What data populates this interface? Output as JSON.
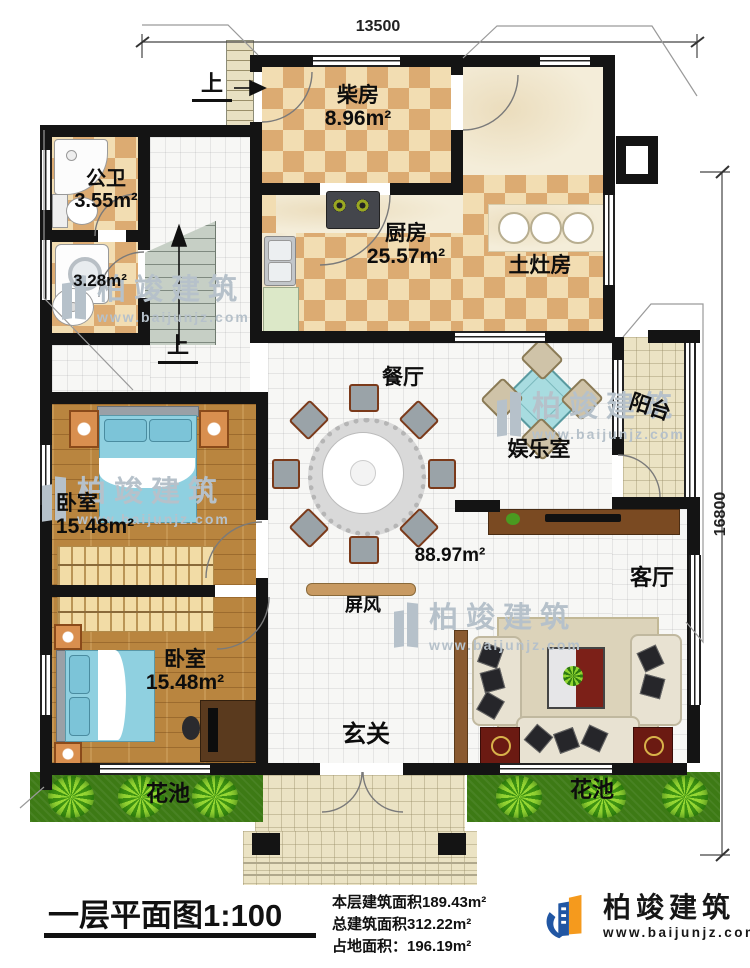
{
  "dimensions": {
    "top_width": "13500",
    "right_height": "16800"
  },
  "stairs": {
    "up_label_top": "上",
    "up_label_mid": "上"
  },
  "rooms": [
    {
      "id": "chaifang",
      "name": "柴房",
      "area": "8.96m²"
    },
    {
      "id": "gongwei",
      "name": "公卫",
      "area": "3.55m²"
    },
    {
      "id": "xiyifang",
      "name": "",
      "area": "3.28m²"
    },
    {
      "id": "chufang",
      "name": "厨房",
      "area": "25.57m²"
    },
    {
      "id": "tuzaofang",
      "name": "土灶房",
      "area": ""
    },
    {
      "id": "canting",
      "name": "餐厅",
      "area": ""
    },
    {
      "id": "yuleshi",
      "name": "娱乐室",
      "area": ""
    },
    {
      "id": "yangtai",
      "name": "阳台",
      "area": ""
    },
    {
      "id": "bedroom-upper",
      "name": "卧室",
      "area": "15.48m²"
    },
    {
      "id": "bedroom-lower",
      "name": "卧室",
      "area": "15.48m²"
    },
    {
      "id": "keting",
      "name": "客厅",
      "area": ""
    },
    {
      "id": "xuanguan",
      "name": "玄关",
      "area": ""
    },
    {
      "id": "huachi-left",
      "name": "花池",
      "area": ""
    },
    {
      "id": "huachi-right",
      "name": "花池",
      "area": ""
    }
  ],
  "annotations": {
    "open_area": "88.97m²",
    "pingfeng": "屏风"
  },
  "footer": {
    "plan_title": "一层平面图",
    "plan_scale": "1:100",
    "stat_floor": "本层建筑面积189.43m²",
    "stat_total": "总建筑面积312.22m²",
    "stat_land": "占地面积：196.19m²"
  },
  "brand": {
    "name": "柏竣建筑",
    "website": "www.baijunjz.com"
  },
  "watermark": {
    "name": "柏竣建筑",
    "website": "www.baijunjz.com"
  },
  "colors": {
    "wall": "#141414",
    "checker_light": "#f2ddb2",
    "checker_dark": "#dcab72",
    "grass": "#3d7a15",
    "brand_blue": "#2156a3",
    "brand_orange": "#f59a1d"
  }
}
